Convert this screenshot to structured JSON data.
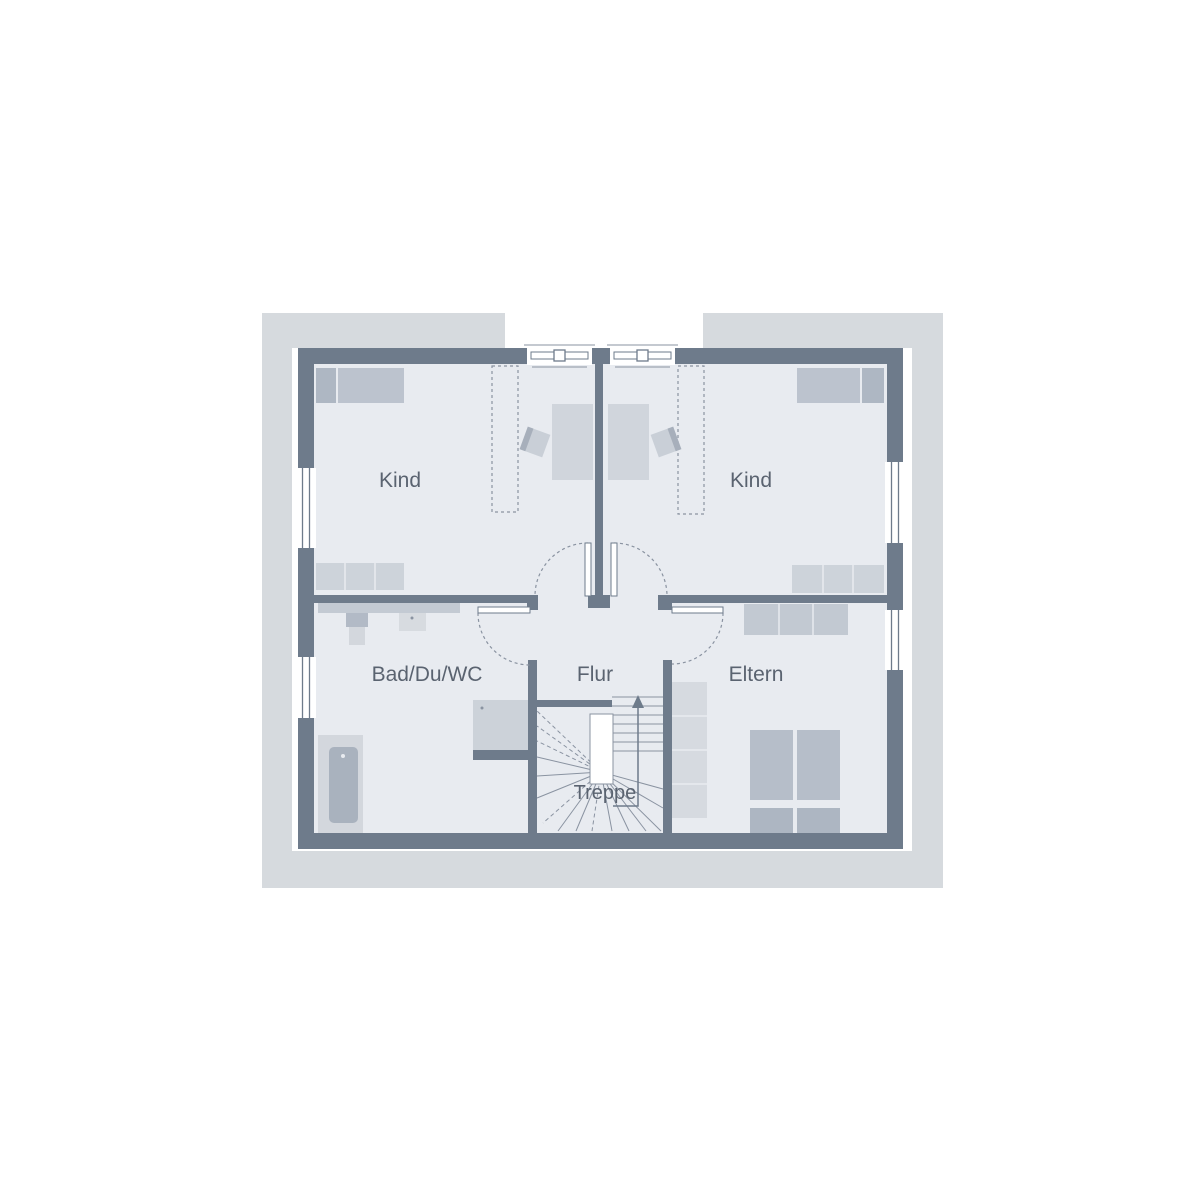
{
  "plan": {
    "type": "floor-plan",
    "rooms": [
      {
        "name": "kind-left",
        "label": "Kind"
      },
      {
        "name": "kind-right",
        "label": "Kind"
      },
      {
        "name": "bath",
        "label": "Bad/Du/WC"
      },
      {
        "name": "hall",
        "label": "Flur"
      },
      {
        "name": "parents",
        "label": "Eltern"
      },
      {
        "name": "stairs",
        "label": "Treppe"
      }
    ],
    "stair_direction": "up",
    "colors": {
      "wall": "#6e7b8b",
      "floor": "#e8ebf0",
      "roof_outline": "#d6dade",
      "furniture_light": "#d3d7dd",
      "furniture_medium": "#c5ccd5",
      "furniture_dark": "#b2bac6",
      "thin_line": "#8a93a1",
      "label_text": "#5a6370",
      "background": "#ffffff"
    }
  }
}
